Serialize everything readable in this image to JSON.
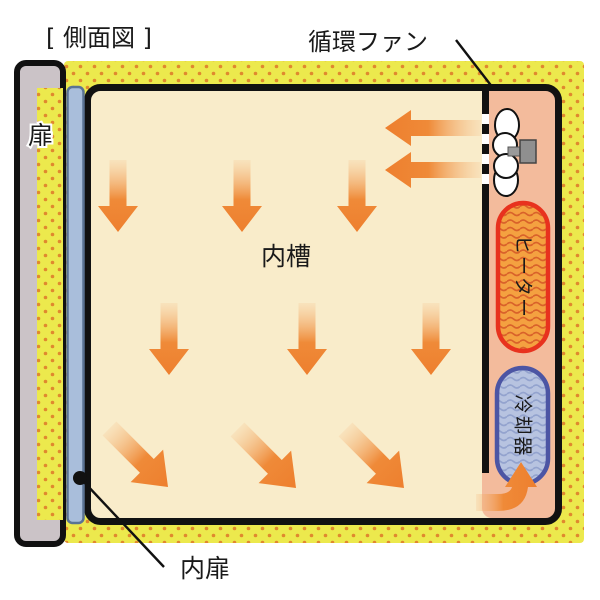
{
  "diagram": {
    "title": "[ 側面図 ]",
    "labels": {
      "circulation_fan": "循環ファン",
      "door": "扉",
      "inner_chamber": "内槽",
      "inner_door": "内扉",
      "heater": "ヒーター",
      "cooler": "冷却器"
    },
    "colors": {
      "insulation_yellow": "#ece94d",
      "insulation_dot_orange": "#e0882e",
      "chamber_cream": "#f9ecca",
      "fan_compartment_salmon": "#f3bb9c",
      "airflow_arrow_orange": "#ee7f2e",
      "heater_border_red": "#e8321e",
      "heater_fill_orange": "#f4a140",
      "heater_wave_orange": "#d9622a",
      "cooler_border_blue": "#4c55a4",
      "cooler_fill_blue": "#b7c3e0",
      "cooler_wave_blue": "#93a3ce",
      "door_gray": "#cbc3c7",
      "inner_door_blue": "#a9bedb",
      "outline_black": "#111111"
    }
  }
}
